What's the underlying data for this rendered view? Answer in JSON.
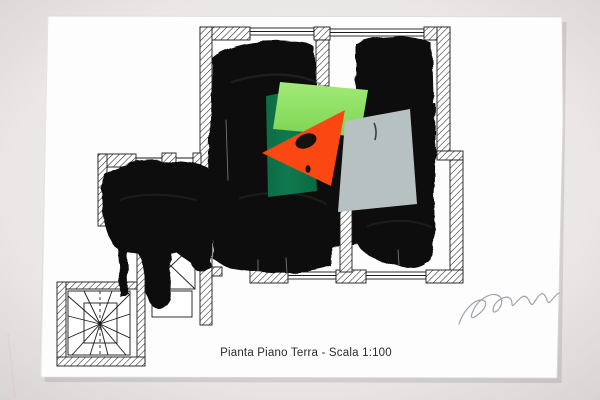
{
  "artwork": {
    "kind": "mixed-media collage over architectural floor plan (photographed sheet)",
    "caption": "Pianta Piano Terra - Scala 1:100",
    "signature": "illegible pencil signature",
    "colors": {
      "background": "#eae7e6",
      "background_edge": "#d7d3d2",
      "paper": "#fdfdfd",
      "paper_edge": "#d9d5d3",
      "ink": "#1b1b1b",
      "paint": "#0d0c0b",
      "paint_sheen": "#33402c",
      "drybrush": "#f2f1ef",
      "lime_green": "#8ddf63",
      "lime_green_light": "#a2ea79",
      "dark_green": "#0f7a4e",
      "orange_red": "#fb4712",
      "gray_blue": "#b8c1c2",
      "blob_on_collage": "#16130f",
      "pencil": "#9aa3ae",
      "caption_ink": "#2b2b2b"
    }
  }
}
